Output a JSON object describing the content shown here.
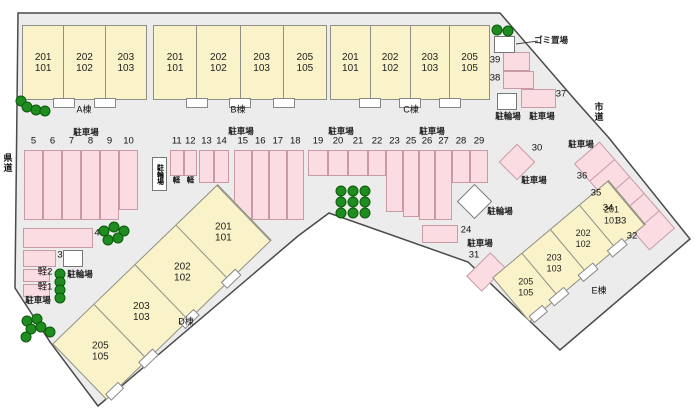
{
  "colors": {
    "site_fill": "#ececec",
    "site_border": "#4a4a4a",
    "building_fill": "#faf3c9",
    "building_border": "#8f8f85",
    "stall_fill": "#fbdce3",
    "stall_border": "#c79aa5",
    "tree_fill": "#1f8c1f",
    "tree_border": "#0a5a0a"
  },
  "roads": {
    "left": "県道",
    "right": "市道"
  },
  "area_labels": {
    "parking": "駐車場",
    "bicycle_parking": "駐輪場",
    "garbage": "ゴミ置場"
  },
  "buildings": [
    {
      "id": "A",
      "label": "A棟",
      "units": [
        [
          "201",
          "101"
        ],
        [
          "202",
          "102"
        ],
        [
          "203",
          "103"
        ]
      ]
    },
    {
      "id": "B",
      "label": "B棟",
      "units": [
        [
          "201",
          "101"
        ],
        [
          "202",
          "102"
        ],
        [
          "203",
          "103"
        ],
        [
          "205",
          "105"
        ]
      ]
    },
    {
      "id": "C",
      "label": "C棟",
      "units": [
        [
          "201",
          "101"
        ],
        [
          "202",
          "102"
        ],
        [
          "203",
          "103"
        ],
        [
          "205",
          "105"
        ]
      ]
    },
    {
      "id": "D",
      "label": "D棟",
      "units": [
        [
          "201",
          "101"
        ],
        [
          "202",
          "102"
        ],
        [
          "203",
          "103"
        ],
        [
          "205",
          "105"
        ]
      ]
    },
    {
      "id": "E",
      "label": "E棟",
      "units": [
        [
          "201",
          "101"
        ],
        [
          "202",
          "102"
        ],
        [
          "203",
          "103"
        ],
        [
          "205",
          "105"
        ]
      ]
    }
  ],
  "parking_stalls": {
    "row_left": [
      "5",
      "6",
      "7",
      "8",
      "9",
      "10"
    ],
    "row_middle": [
      "11",
      "12",
      "13",
      "14",
      "15",
      "16",
      "17",
      "18",
      "19",
      "20",
      "21",
      "22",
      "23",
      "25",
      "26",
      "27",
      "28",
      "29"
    ],
    "kei_row": [
      "軽",
      "軽"
    ],
    "kei_stalls": [
      "軽1",
      "軽2"
    ],
    "numbered": [
      "3",
      "4",
      "24",
      "30",
      "31",
      "32",
      "33",
      "34",
      "35",
      "36",
      "37",
      "38",
      "39"
    ]
  }
}
